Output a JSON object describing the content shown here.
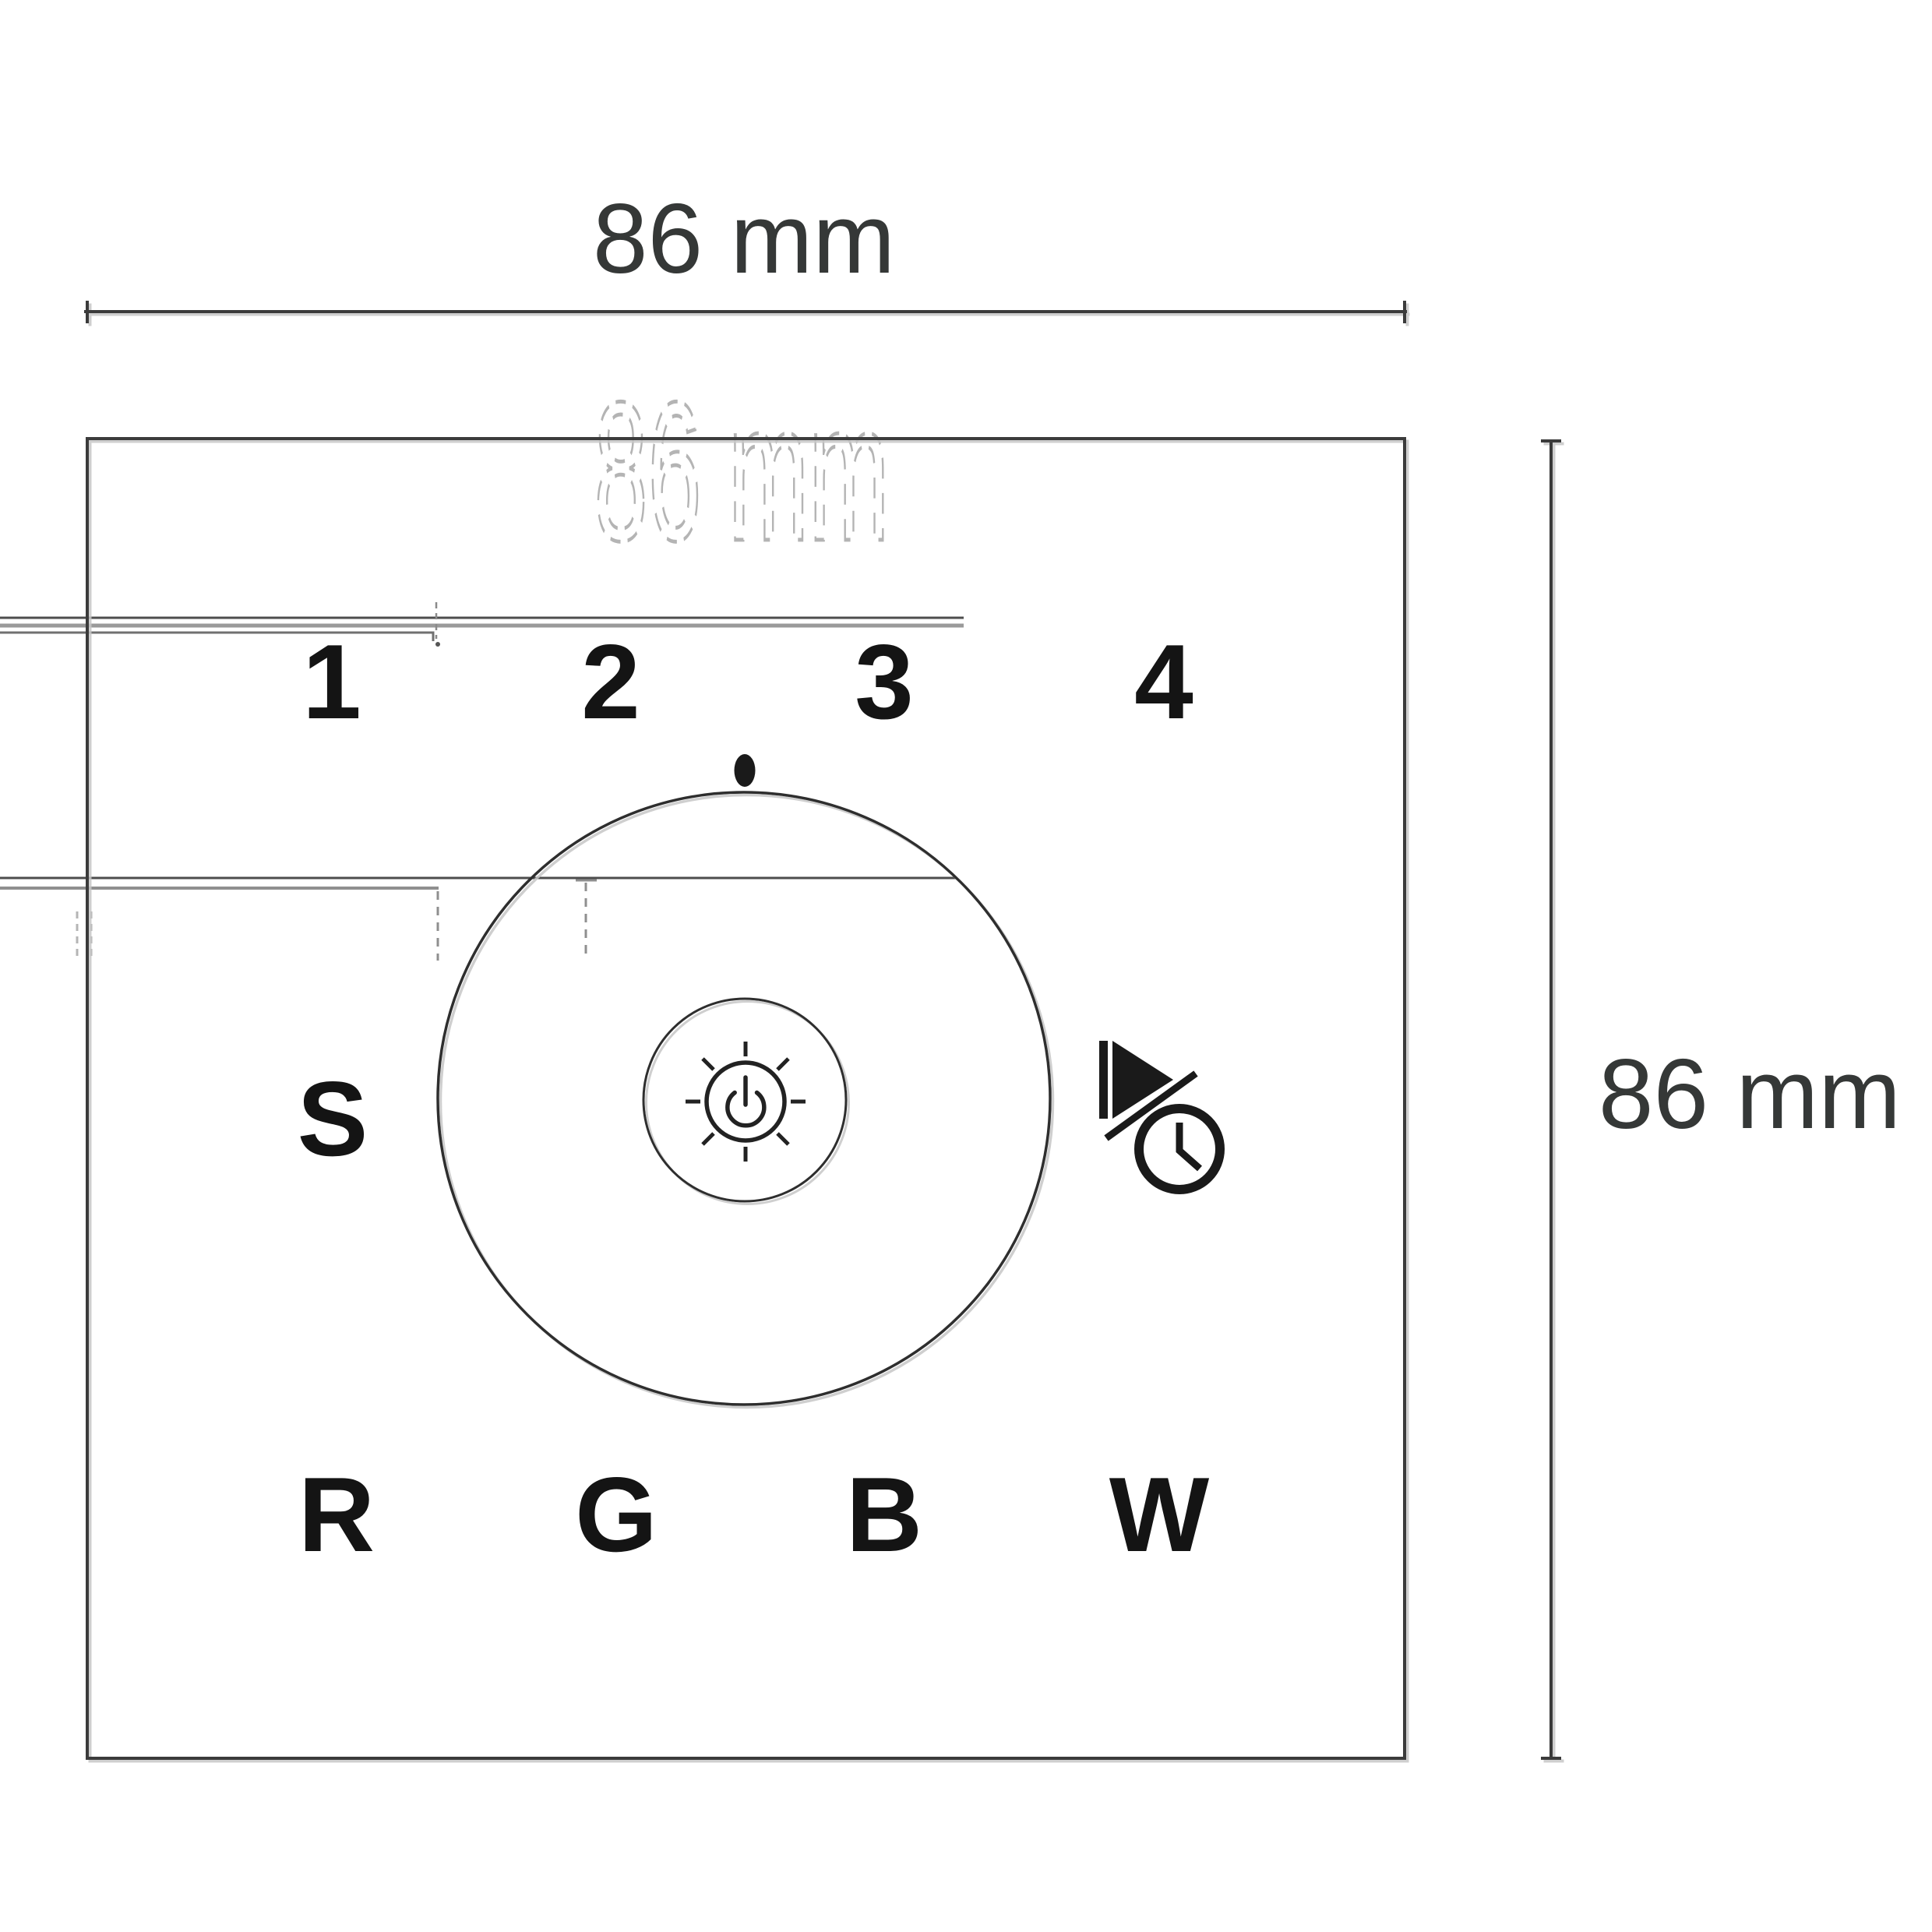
{
  "dimension_labels": {
    "top": "86 mm",
    "right": "86 mm",
    "ghost": "86 mm"
  },
  "panel": {
    "channel_buttons": [
      "1",
      "2",
      "3",
      "4"
    ],
    "scene_button": "S",
    "color_buttons": [
      "R",
      "G",
      "B",
      "W"
    ]
  },
  "icons": {
    "center_icon": "power-brightness-icon",
    "side_icon": "play-timer-icon",
    "marker": "dial-marker-dot"
  },
  "colors": {
    "ink": "#141414",
    "line": "#3a3a3a",
    "dim_text": "#353837",
    "ghost": "#b4b4b4",
    "shadow": "#c6c6c6",
    "background": "#ffffff"
  }
}
